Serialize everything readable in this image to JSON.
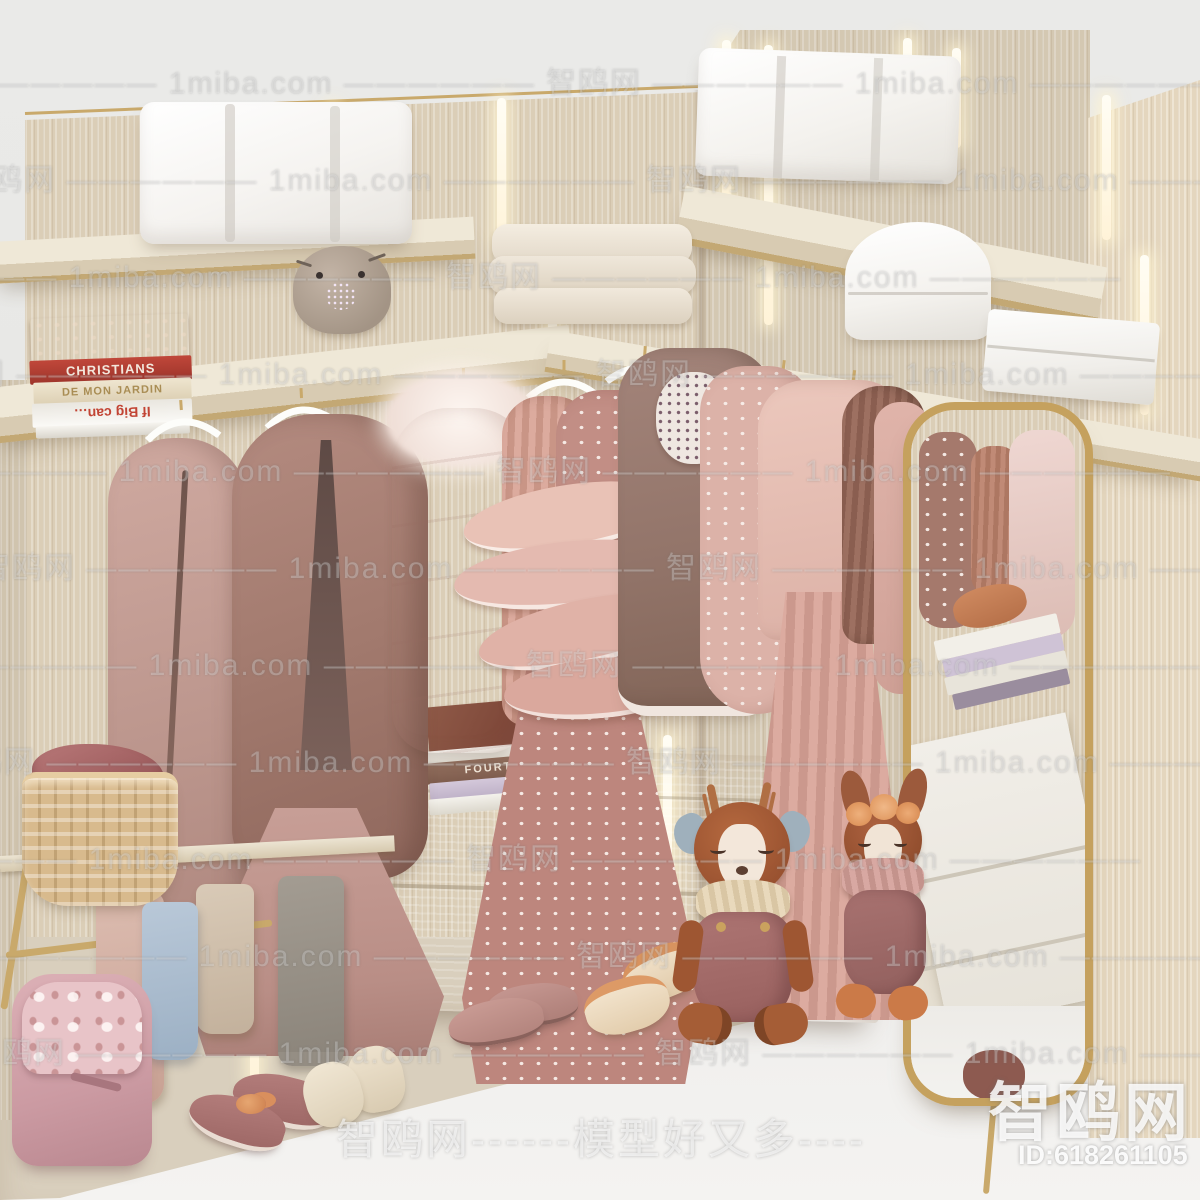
{
  "watermarks": {
    "row_pattern": "智鸥网 —————— 1miba.com —————— 智鸥网 —————— 1miba.com ——————",
    "bottom_banner": "智鸥网------模型好又多----",
    "logo_text": "智鸥网",
    "id_text": "ID:618261105",
    "site": "1miba.com"
  },
  "books": {
    "left_stack": {
      "spine1": "CHRISTIANS",
      "spine2": "DE MON JARDIN",
      "spine3": "If Big can…"
    },
    "center_stack": {
      "spine1": "FOURTH WING"
    }
  },
  "palette": {
    "wall": "#e9e9e7",
    "wood_panel": "#dbceb7",
    "shelf_top": "#efe8d7",
    "gold_trim": "#c9a96b",
    "led_glow": "#fff6dd",
    "floor_white": "#f3f2f0",
    "clothes_rose": "#c5a29b",
    "clothes_mauve": "#a87e73",
    "clothes_blush": "#e2bbb1",
    "mirror_frame_gold": "#c5a15e",
    "plush_deer_brown": "#a8593b",
    "basket_rattan": "#d9bb8e"
  }
}
